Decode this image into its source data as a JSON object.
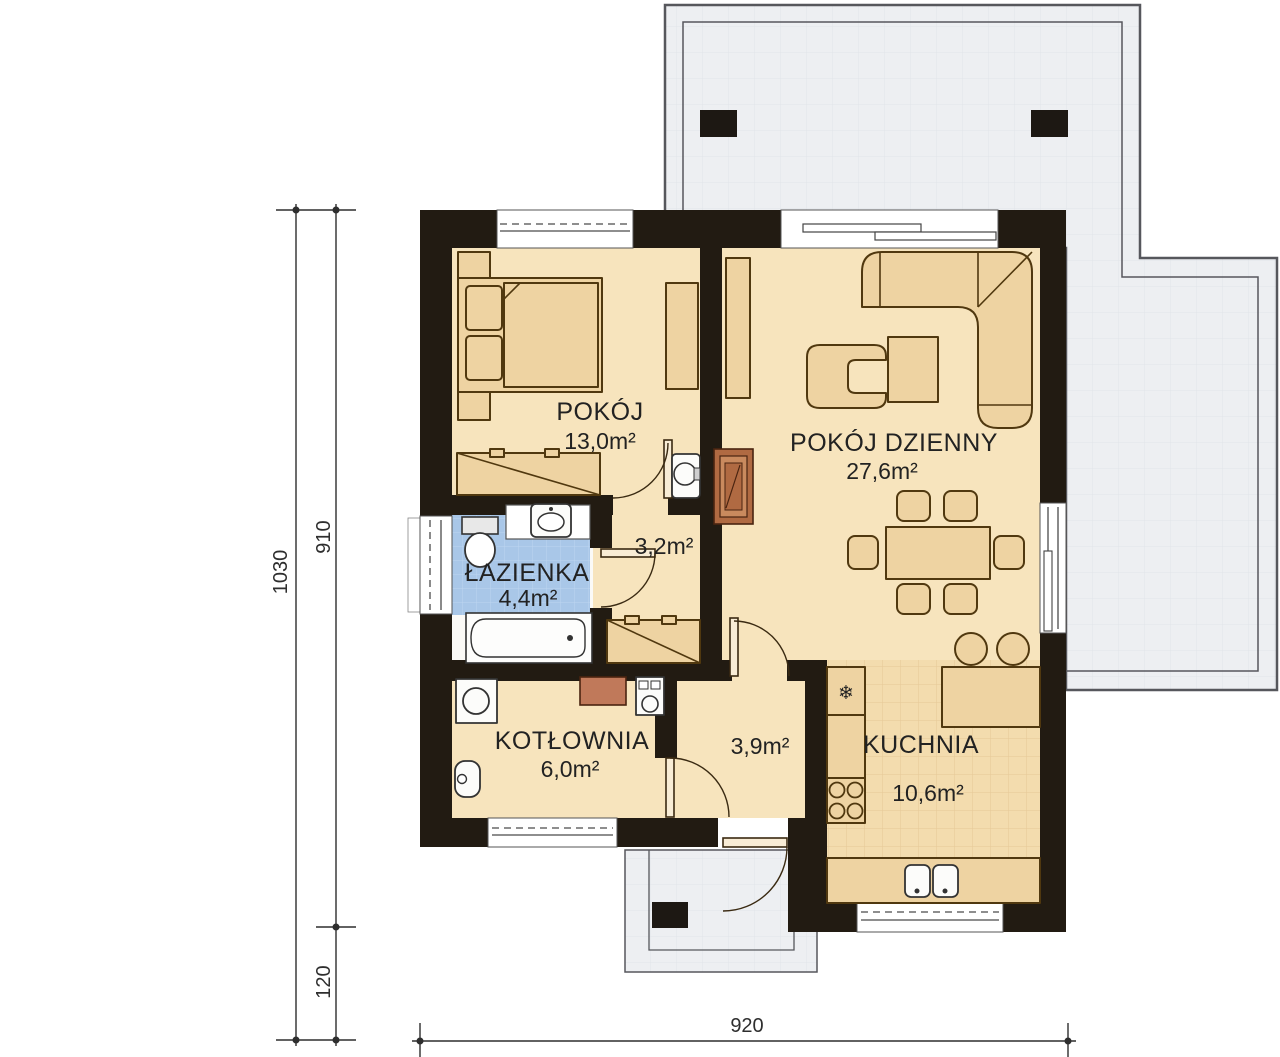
{
  "plan_title": "house-ground-floor-plan",
  "rooms": {
    "bedroom": {
      "name": "POKÓJ",
      "area": "13,0m²"
    },
    "living": {
      "name": "POKÓJ DZIENNY",
      "area": "27,6m²"
    },
    "bathroom": {
      "name": "ŁAZIENKA",
      "area": "4,4m²"
    },
    "boiler": {
      "name": "KOTŁOWNIA",
      "area": "6,0m²"
    },
    "kitchen": {
      "name": "KUCHNIA",
      "area": "10,6m²"
    },
    "hall_small": {
      "area": "3,2m²"
    },
    "hall_entry": {
      "area": "3,9m²"
    }
  },
  "dimensions": {
    "left_total": "1030",
    "left_main": "910",
    "left_porch": "120",
    "bottom_width": "920"
  },
  "icons": {
    "fridge_icon": "❄"
  },
  "colors": {
    "wall": "#221b12",
    "floor": "#f7e4bd",
    "furniture": "#eed3a2",
    "bathroom_tile": "#a9c7e8",
    "kitchen_tile": "#f3dcae",
    "terrace": "#edeff2",
    "chimney": "#b06a42",
    "boiler_unit": "#c0795a"
  }
}
